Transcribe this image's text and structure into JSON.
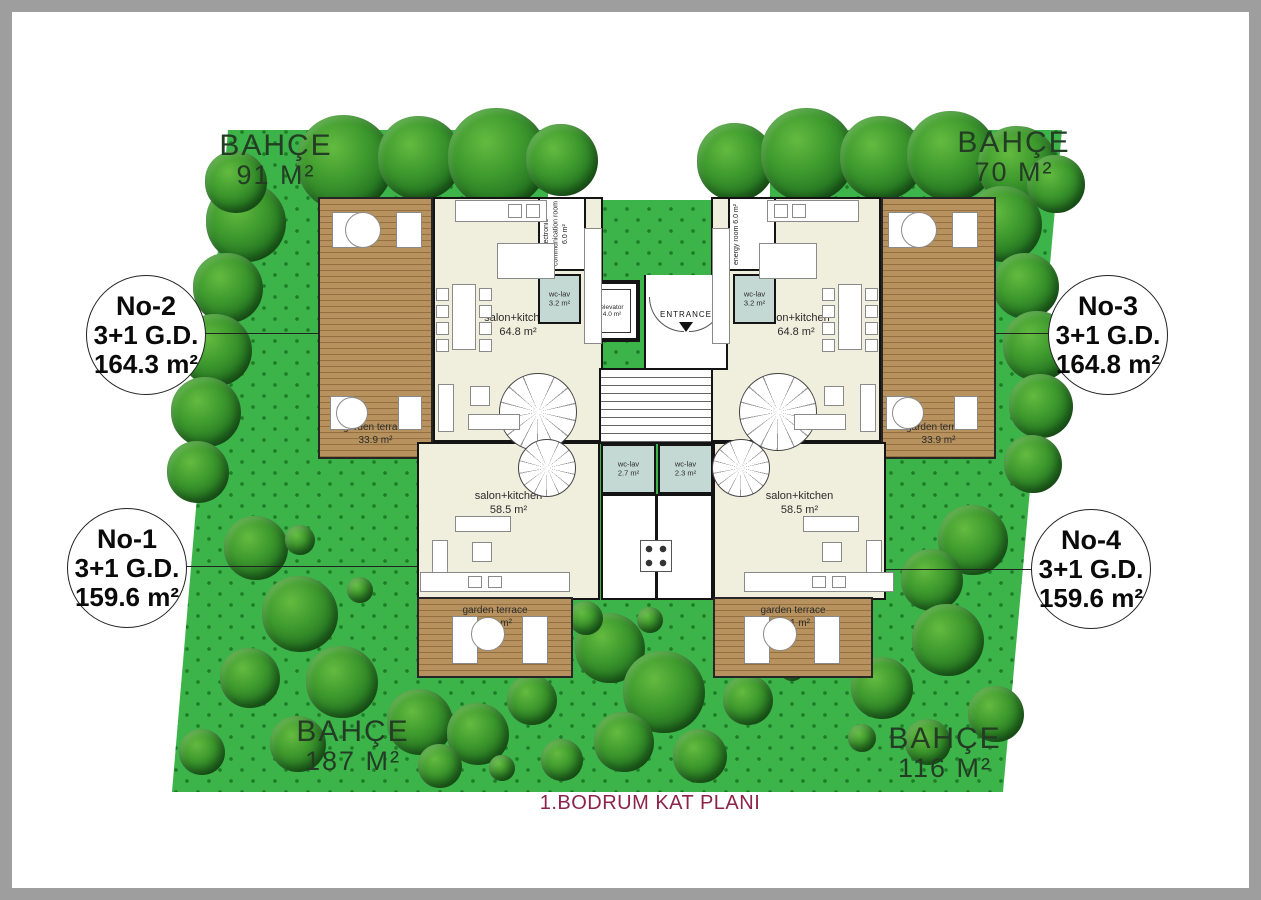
{
  "title": "1.BODRUM KAT PLANI",
  "gardens": [
    {
      "position": "top-left",
      "label": "BAHÇE",
      "area": "91 M²"
    },
    {
      "position": "top-right",
      "label": "BAHÇE",
      "area": "70 M²"
    },
    {
      "position": "bottom-left",
      "label": "BAHÇE",
      "area": "187 M²"
    },
    {
      "position": "bottom-right",
      "label": "BAHÇE",
      "area": "116 M²"
    }
  ],
  "units": [
    {
      "no": "No-1",
      "type": "3+1 G.D.",
      "area": "159.6 m²"
    },
    {
      "no": "No-2",
      "type": "3+1 G.D.",
      "area": "164.3 m²"
    },
    {
      "no": "No-3",
      "type": "3+1 G.D.",
      "area": "164.8 m²"
    },
    {
      "no": "No-4",
      "type": "3+1 G.D.",
      "area": "159.6 m²"
    }
  ],
  "rooms": {
    "salon_no2": {
      "name": "salon+kitchen",
      "area": "64.8 m²"
    },
    "salon_no3": {
      "name": "salon+kitchen",
      "area": "64.8 m²"
    },
    "salon_no1": {
      "name": "salon+kitchen",
      "area": "58.5 m²"
    },
    "salon_no4": {
      "name": "salon+kitchen",
      "area": "58.5 m²"
    },
    "terrace_no2": {
      "name": "garden terrace",
      "area": "33.9 m²"
    },
    "terrace_no3": {
      "name": "garden terrace",
      "area": "33.9 m²"
    },
    "terrace_no1": {
      "name": "garden terrace",
      "area": "24.1 m²"
    },
    "terrace_no4": {
      "name": "garden terrace",
      "area": "24.1 m²"
    },
    "electronic_room": {
      "name": "electronic communication room",
      "area": "6.0 m²"
    },
    "energy_room": {
      "name": "energy room",
      "area": "6.0 m²"
    },
    "wc_no2": {
      "name": "wc-lav",
      "area": "3.2 m²"
    },
    "wc_no3": {
      "name": "wc-lav",
      "area": "3.2 m²"
    },
    "wc_no1": {
      "name": "wc-lav",
      "area": "2.7 m²"
    },
    "wc_no4": {
      "name": "wc-lav",
      "area": "2.3 m²"
    },
    "elevator": {
      "name": "elevator",
      "area": "4.0 m²"
    },
    "entrance": {
      "name": "ENTRANCE"
    }
  },
  "colors": {
    "grass": "#3cb44a",
    "grass_dot": "#1f7d27",
    "deck": "#b7925f",
    "floor": "#f0eedd",
    "wall": "#141414",
    "wc": "#c4d8d4",
    "title_text": "#8d2349",
    "garden_text": "#233c23"
  }
}
